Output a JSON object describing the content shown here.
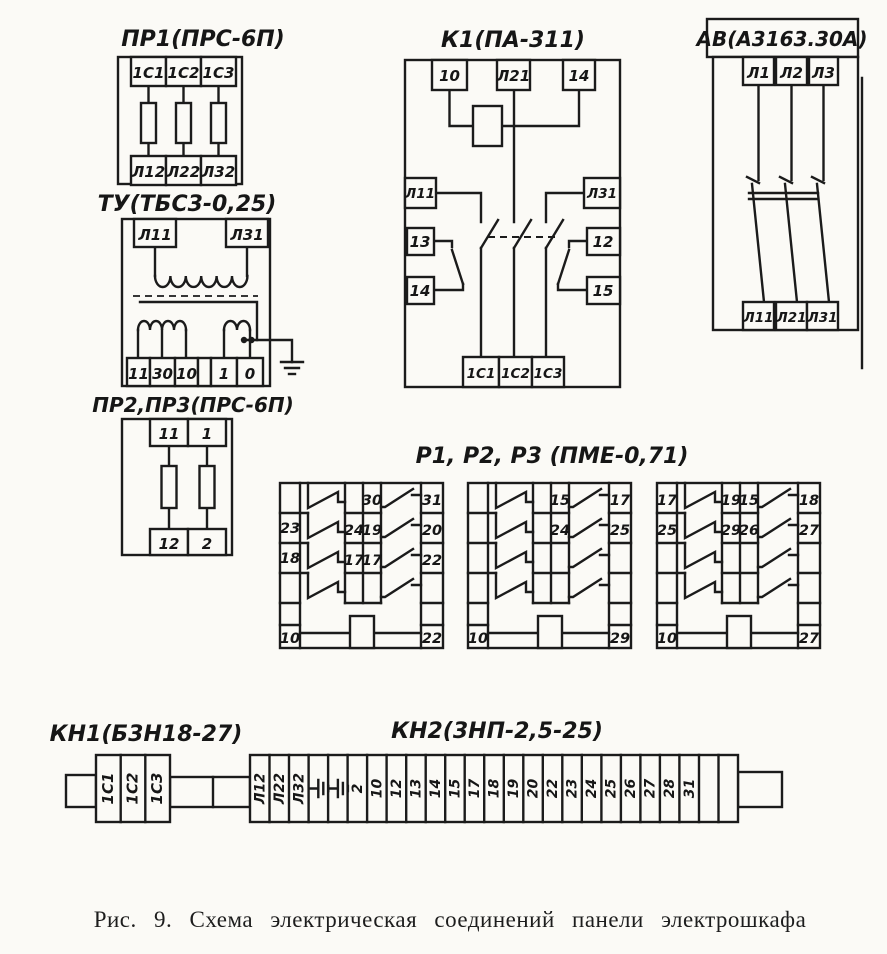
{
  "colors": {
    "paper": "#fbfaf6",
    "ink": "#1b1b1b"
  },
  "caption": "Рис. 9. Схема электрическая соединений панели электрошкафа",
  "pr1": {
    "title": "ПР1(ПРС-6П)",
    "top": [
      "1С1",
      "1С2",
      "1С3"
    ],
    "bottom": [
      "Л12",
      "Л22",
      "Л32"
    ]
  },
  "tu": {
    "title": "ТУ(ТБС3-0,25)",
    "top": [
      "Л11",
      "Л31"
    ],
    "bottom": [
      "11",
      "30",
      "10",
      "",
      "1",
      "0"
    ]
  },
  "pr23": {
    "title": "ПР2,ПР3(ПРС-6П)",
    "top": [
      "11",
      "1"
    ],
    "bottom": [
      "12",
      "2"
    ]
  },
  "k1": {
    "title": "К1(ПА-311)",
    "top": [
      "10",
      "Л21",
      "14"
    ],
    "left": [
      "Л11",
      "13",
      "14"
    ],
    "right": [
      "Л31",
      "12",
      "15"
    ],
    "bottom": [
      "1С1",
      "1С2",
      "1С3"
    ]
  },
  "av": {
    "title": "АВ(А3163.30А)",
    "top": [
      "Л1",
      "Л2",
      "Л3"
    ],
    "bottom": [
      "Л11",
      "Л21",
      "Л31"
    ]
  },
  "relays": {
    "title": "Р1, Р2, Р3 (ПМЕ-0,71)",
    "r1": {
      "left": [
        "",
        "23",
        "18",
        "",
        ""
      ],
      "mid_left": [
        "",
        "24",
        "17",
        ""
      ],
      "mid_right": [
        "30",
        "19",
        "17",
        ""
      ],
      "right": [
        "31",
        "20",
        "22",
        "",
        ""
      ],
      "bottom_left": "10",
      "bottom_right": "22"
    },
    "r2": {
      "left": [
        "",
        "",
        "",
        "",
        ""
      ],
      "mid_left": [
        "",
        "",
        "",
        ""
      ],
      "mid_right": [
        "15",
        "24",
        "",
        ""
      ],
      "right": [
        "17",
        "25",
        "",
        "",
        ""
      ],
      "bottom_left": "10",
      "bottom_right": "29"
    },
    "r3": {
      "left": [
        "17",
        "25",
        "",
        "",
        ""
      ],
      "mid_left": [
        "19",
        "29",
        "",
        ""
      ],
      "mid_right": [
        "15",
        "26",
        "",
        ""
      ],
      "right": [
        "18",
        "27",
        "",
        "",
        ""
      ],
      "bottom_left": "10",
      "bottom_right": "27"
    }
  },
  "kn1": {
    "title": "КН1(Б3Н18-27)",
    "terminals": [
      "1С1",
      "1С2",
      "1С3"
    ]
  },
  "kn2": {
    "title": "КН2(3НП-2,5-25)",
    "terminals": [
      "Л12",
      "Л22",
      "Л32",
      "gnd",
      "gnd",
      "2",
      "10",
      "12",
      "13",
      "14",
      "15",
      "17",
      "18",
      "19",
      "20",
      "22",
      "23",
      "24",
      "25",
      "26",
      "27",
      "28",
      "31",
      "",
      ""
    ]
  }
}
